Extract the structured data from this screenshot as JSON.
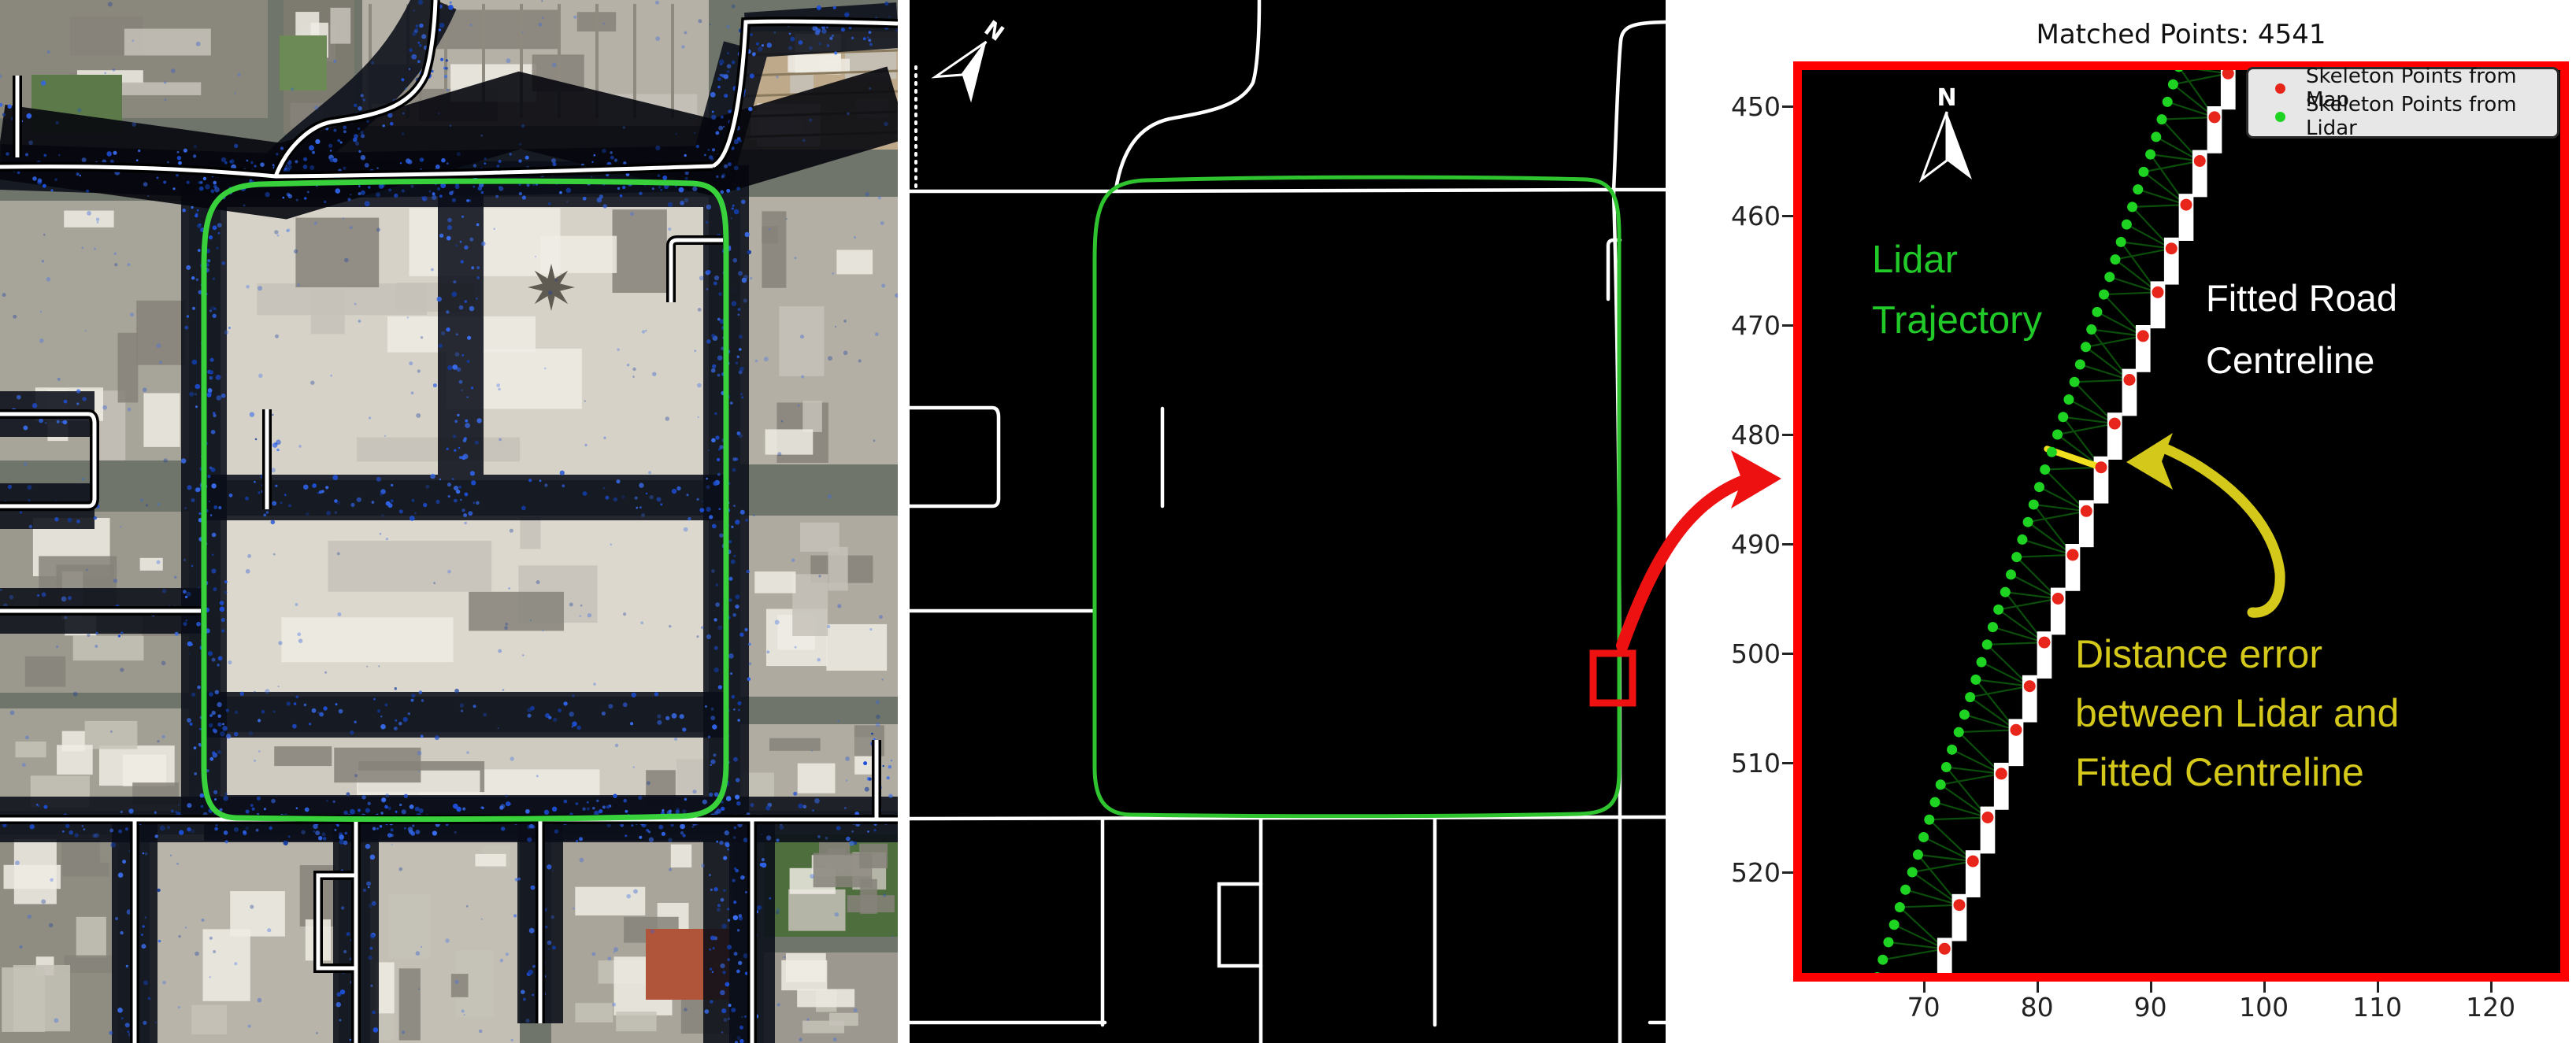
{
  "figure": {
    "colors": {
      "trajectory_green": "#2fc32f",
      "left_loop_green": "#38d13c",
      "lidar_point_blue": "#2a55d4",
      "skeleton_white": "#ffffff",
      "highlight_red": "#ee1111",
      "plot_border_red": "#ff0000",
      "annotation_yellow": "#d4c81a",
      "annotation_green": "#21c929",
      "legend_bg": "#e7e7e7",
      "map_dot_red": "#e8251a",
      "lidar_dot_green": "#1ed321",
      "match_line_green": "#0b4d0b"
    }
  },
  "middle_panel": {
    "north_label": "N"
  },
  "right_panel": {
    "title": "Matched Points: 4541",
    "north_label": "N",
    "legend": [
      {
        "label": "Skeleton Points from Map",
        "color": "#e8251a"
      },
      {
        "label": "Skeleton Points from Lidar",
        "color": "#1ed321"
      }
    ],
    "annotations": {
      "lidar": [
        "Lidar",
        "Trajectory"
      ],
      "fitted": [
        "Fitted Road",
        "Centreline"
      ],
      "distance": [
        "Distance error",
        "between Lidar and",
        "Fitted Centreline"
      ]
    }
  },
  "chart_data": {
    "type": "scatter",
    "title": "Matched Points: 4541",
    "matched_points": 4541,
    "xlim": [
      58.5,
      126.9
    ],
    "ylim": [
      445.9,
      530.0
    ],
    "y_inverted": true,
    "grid": false,
    "legend_position": "upper right",
    "x_ticks": [
      70,
      80,
      90,
      100,
      110,
      120
    ],
    "y_ticks": [
      450,
      460,
      470,
      480,
      490,
      500,
      510,
      520
    ],
    "series": [
      {
        "name": "Skeleton Points from Lidar",
        "color": "#1ed321",
        "points": [
          [
            92.5,
            446.4
          ],
          [
            92.0,
            448.0
          ],
          [
            91.5,
            449.6
          ],
          [
            91.0,
            451.2
          ],
          [
            90.5,
            452.8
          ],
          [
            90.0,
            454.4
          ],
          [
            89.4,
            456.0
          ],
          [
            88.9,
            457.6
          ],
          [
            88.4,
            459.2
          ],
          [
            87.9,
            460.8
          ],
          [
            87.4,
            462.4
          ],
          [
            86.9,
            464.0
          ],
          [
            86.4,
            465.6
          ],
          [
            85.9,
            467.2
          ],
          [
            85.3,
            468.8
          ],
          [
            84.8,
            470.4
          ],
          [
            84.3,
            472.0
          ],
          [
            83.8,
            473.6
          ],
          [
            83.3,
            475.2
          ],
          [
            82.8,
            476.8
          ],
          [
            82.3,
            478.4
          ],
          [
            81.8,
            480.0
          ],
          [
            81.3,
            481.6
          ],
          [
            80.7,
            483.2
          ],
          [
            80.2,
            484.8
          ],
          [
            79.7,
            486.4
          ],
          [
            79.2,
            488.0
          ],
          [
            78.7,
            489.6
          ],
          [
            78.2,
            491.2
          ],
          [
            77.7,
            492.8
          ],
          [
            77.2,
            494.4
          ],
          [
            76.6,
            496.0
          ],
          [
            76.1,
            497.6
          ],
          [
            75.6,
            499.2
          ],
          [
            75.1,
            500.8
          ],
          [
            74.6,
            502.4
          ],
          [
            74.1,
            504.0
          ],
          [
            73.6,
            505.6
          ],
          [
            73.1,
            507.2
          ],
          [
            72.5,
            508.8
          ],
          [
            72.0,
            510.4
          ],
          [
            71.5,
            512.0
          ],
          [
            71.0,
            513.6
          ],
          [
            70.5,
            515.2
          ],
          [
            70.0,
            516.8
          ],
          [
            69.5,
            518.4
          ],
          [
            69.0,
            520.0
          ],
          [
            68.4,
            521.6
          ],
          [
            67.9,
            523.2
          ],
          [
            67.4,
            524.8
          ],
          [
            66.9,
            526.4
          ],
          [
            66.4,
            528.0
          ],
          [
            65.9,
            529.6
          ]
        ]
      },
      {
        "name": "Skeleton Points from Map",
        "color": "#e8251a",
        "bar_color": "#ffffff",
        "bar_size": [
          1.3,
          4.3
        ],
        "dot_offset": [
          0.65,
          1.0
        ],
        "bars": [
          [
            96.2,
            446.0
          ],
          [
            95.0,
            450.0
          ],
          [
            93.7,
            454.0
          ],
          [
            92.5,
            458.0
          ],
          [
            91.2,
            462.0
          ],
          [
            90.0,
            466.0
          ],
          [
            88.7,
            470.0
          ],
          [
            87.5,
            474.0
          ],
          [
            86.2,
            478.0
          ],
          [
            85.0,
            482.0
          ],
          [
            83.7,
            486.0
          ],
          [
            82.5,
            490.0
          ],
          [
            81.2,
            494.0
          ],
          [
            80.0,
            498.0
          ],
          [
            78.7,
            502.0
          ],
          [
            77.5,
            506.0
          ],
          [
            76.2,
            510.0
          ],
          [
            75.0,
            514.0
          ],
          [
            73.7,
            518.0
          ],
          [
            72.5,
            522.0
          ],
          [
            71.2,
            526.0
          ]
        ]
      }
    ],
    "highlight": {
      "trajectory_index": 22,
      "bar_index": 9,
      "color": "#f0e020"
    }
  }
}
